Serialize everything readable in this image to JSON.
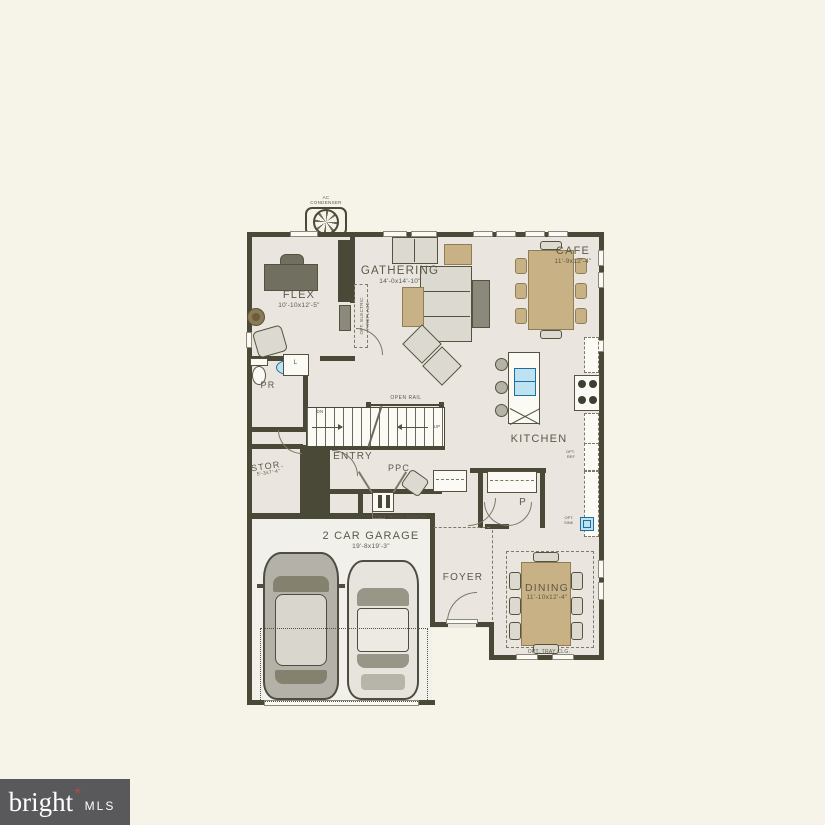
{
  "colors": {
    "background": "#f6f3e8",
    "wall": "#4a4836",
    "floor": "#eae6df",
    "furniture_tan": "#c9b186",
    "fixture_blue": "#bfe2f2",
    "logo_background": "#59585a",
    "logo_star": "#c44b35"
  },
  "equipment": {
    "ac_line1": "AC",
    "ac_line2": "CONDENSER"
  },
  "rooms": {
    "flex": {
      "name": "FLEX",
      "dims": "10'-10x12'-5\""
    },
    "gathering": {
      "name": "GATHERING",
      "dims": "14'-0x14'-10\""
    },
    "cafe": {
      "name": "CAFE",
      "dims": "11'-9x12'-4\""
    },
    "kitchen": {
      "name": "KITCHEN"
    },
    "powder": {
      "name": "PR"
    },
    "linen": {
      "name": "L"
    },
    "entry": {
      "name": "ENTRY"
    },
    "storage": {
      "name": "STOR.",
      "dims": "5'-3x7'-4\""
    },
    "ppc": {
      "name": "PPC"
    },
    "garage": {
      "name": "2 CAR GARAGE",
      "dims": "19'-8x19'-3\""
    },
    "foyer": {
      "name": "FOYER"
    },
    "pantry": {
      "name": "P"
    },
    "dining": {
      "name": "DINING",
      "dims": "11'-10x12'-4\""
    }
  },
  "annotations": {
    "open_rail": "OPEN RAIL",
    "down": "DN",
    "up": "UP",
    "opt_boot_bench": "OPT. BOOT BENCH",
    "opt_tray_ceiling": "OPT. TRAY CLG.",
    "opt_fireplace_line1": "OPT. ELECTRIC",
    "opt_fireplace_line2": "FIREPLACE",
    "opt_ref_line1": "OPT.",
    "opt_ref_line2": "REF",
    "opt_sink_line1": "OPT.",
    "opt_sink_line2": "SINK"
  },
  "watermark": {
    "brand": "bright",
    "star": "✳",
    "suffix": "MLS"
  }
}
